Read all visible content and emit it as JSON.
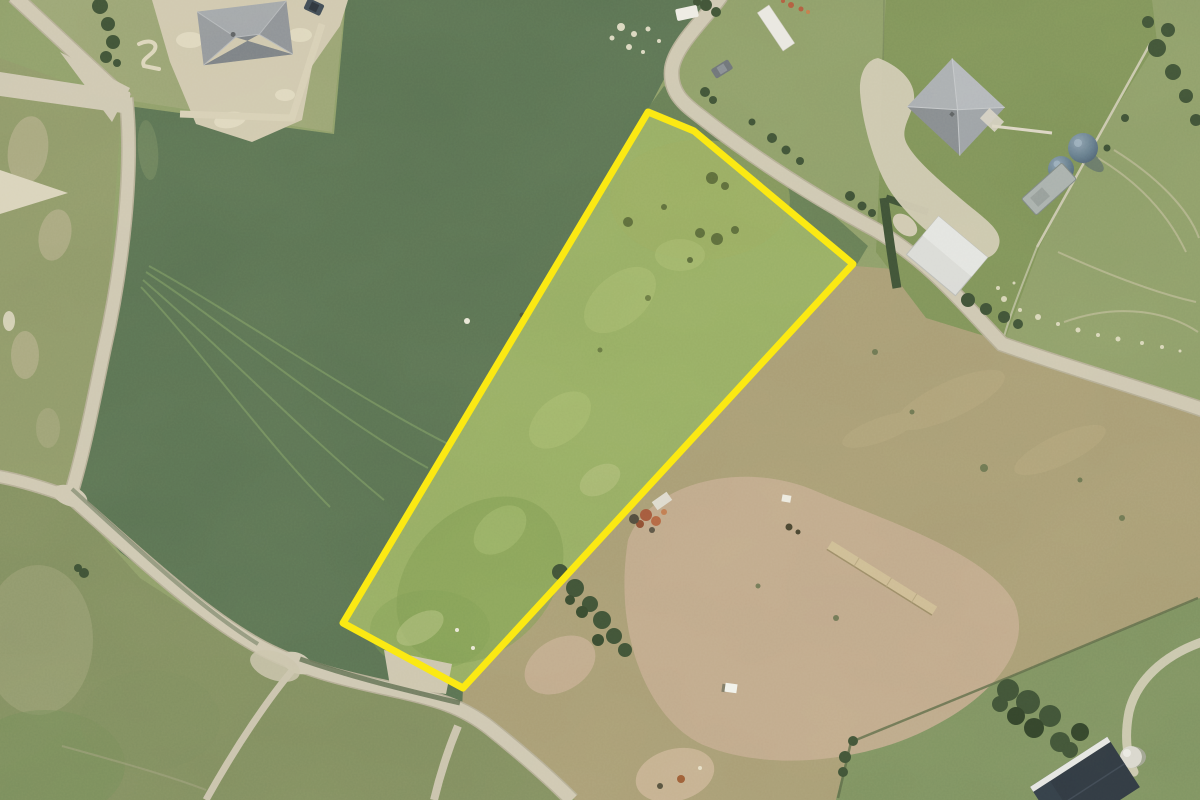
{
  "view": {
    "type": "aerial-photo",
    "width": 1200,
    "height": 800,
    "description": "Aerial photograph of rural lifestyle blocks with one grass parcel highlighted by a yellow boundary line"
  },
  "parcel": {
    "outline_points": "648,112 694,131 853,264 463,688 343,623",
    "outline_color": "#fbe913",
    "outline_width": "7"
  },
  "palette": {
    "road": "#cdc6b1",
    "road_edge": "#b3ac95",
    "hedge": "#3c4f35",
    "field_dark": "#587052",
    "field_parcel": "#95ac63",
    "field_tan": "#a79b74",
    "field_lawn": "#7d9158",
    "field_olive": "#8d9768",
    "field_bottom_left": "#7f8c5f",
    "field_bottom_right": "#7c9060",
    "field_top_right": "#8c9c68",
    "field_top_left_lot": "#98a273",
    "roof_gray": "#8d9196",
    "roof_dark": "#2c3540",
    "shed_white": "#d9dad6",
    "tank_blue": "#5d7183",
    "dirt": "#c2aa8e",
    "highlight_yellow": "#fbe913"
  },
  "features": {
    "highlighted_parcel": "irregular five-sided grass parcel outlined in yellow, centre of image",
    "buildings": [
      {
        "name": "house-northwest",
        "desc": "gray hipped-roof house at top left"
      },
      {
        "name": "house-northeast",
        "desc": "gray hipped-roof house at top right"
      },
      {
        "name": "shed-white",
        "desc": "white-roofed shed south of the northeast house"
      },
      {
        "name": "shed-rusty",
        "desc": "small rusty shed beside the parcel's east edge"
      },
      {
        "name": "building-dark",
        "desc": "dark navy-roofed building at bottom right"
      }
    ],
    "objects": [
      {
        "name": "water-tanks",
        "desc": "two round blue-gray tanks on northeast boundary"
      },
      {
        "name": "trailer-gray",
        "desc": "gray trailer beside the tanks"
      },
      {
        "name": "vehicle-white",
        "desc": "white vehicle near top road bend"
      },
      {
        "name": "car-dark",
        "desc": "dark car on the winding top road"
      },
      {
        "name": "timber-row",
        "desc": "long pale timber row in the southeast paddock"
      },
      {
        "name": "white-box",
        "desc": "small white box in the southeast paddock"
      },
      {
        "name": "dome-tank",
        "desc": "small pale dome tank near the dark building"
      }
    ],
    "roads": [
      {
        "name": "road-northwest",
        "desc": "lane from top-left corner junction running south"
      },
      {
        "name": "road-south",
        "desc": "lane crossing the lower left toward bottom centre with small spurs"
      },
      {
        "name": "road-northeast",
        "desc": "winding lane along the parcel's northeast edge exiting right"
      }
    ],
    "terrain": [
      {
        "name": "field-dark-green",
        "desc": "large dark green pasture west of the parcel with wheel tracks"
      },
      {
        "name": "field-tan",
        "desc": "dry tan paddock east of the parcel with bare dirt patch"
      },
      {
        "name": "field-bottom-right",
        "desc": "green paddock with tree clump at bottom right"
      },
      {
        "name": "hedgerows",
        "desc": "dark hedges along lanes and property boundaries"
      }
    ]
  }
}
